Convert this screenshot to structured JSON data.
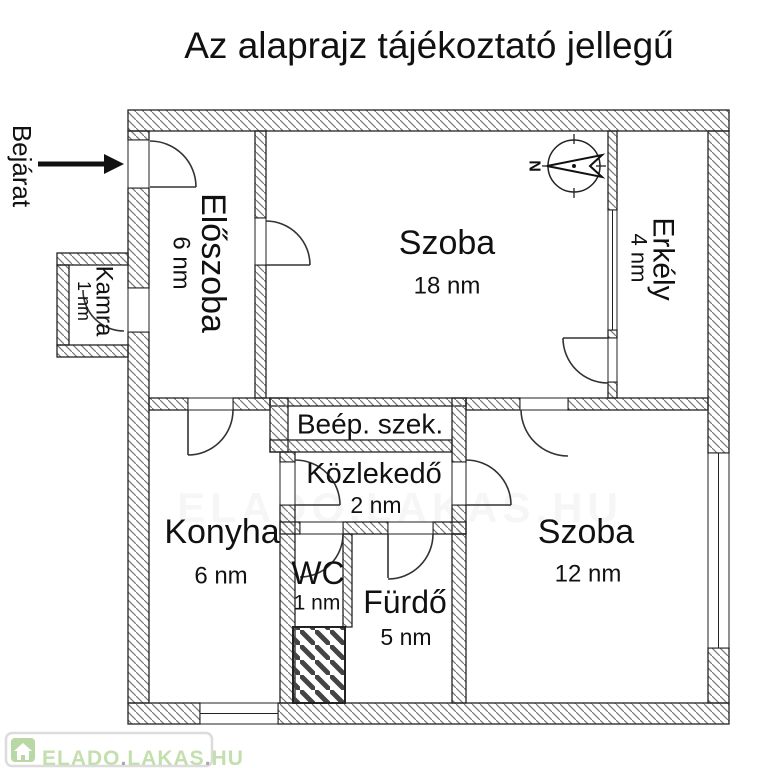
{
  "title": "Az alaprajz tájékoztató jellegű",
  "entrance_label": "Bejárat",
  "compass": {
    "north_letter": "N"
  },
  "rooms": {
    "eloszoba": {
      "name": "Előszoba",
      "area": "6 nm"
    },
    "kamra": {
      "name": "Kamra",
      "area": "1 nm"
    },
    "szoba18": {
      "name": "Szoba",
      "area": "18 nm"
    },
    "erkely": {
      "name": "Erkély",
      "area": "4 nm"
    },
    "beep_szek": {
      "name": "Beép. szek."
    },
    "kozlekedo": {
      "name": "Közlekedő",
      "area": "2 nm"
    },
    "konyha": {
      "name": "Konyha",
      "area": "6 nm"
    },
    "wc": {
      "name": "WC",
      "area": "1 nm"
    },
    "furdo": {
      "name": "Fürdő",
      "area": "5 nm"
    },
    "szoba12": {
      "name": "Szoba",
      "area": "12 nm"
    }
  },
  "watermark_badge": {
    "part1": "ELADO",
    "dot1": ".",
    "part2": "LAKAS",
    "dot2": ".",
    "part3": "HU"
  },
  "watermark_faint": "ELADO.LAKAS.HU",
  "colors": {
    "line": "#222222",
    "hatch": "#777777",
    "badge_green": "#c4dfae",
    "badge_dot_gray": "#a9a9a9",
    "badge_border": "#dcdcdc",
    "icon_green": "#b9d8a6"
  }
}
